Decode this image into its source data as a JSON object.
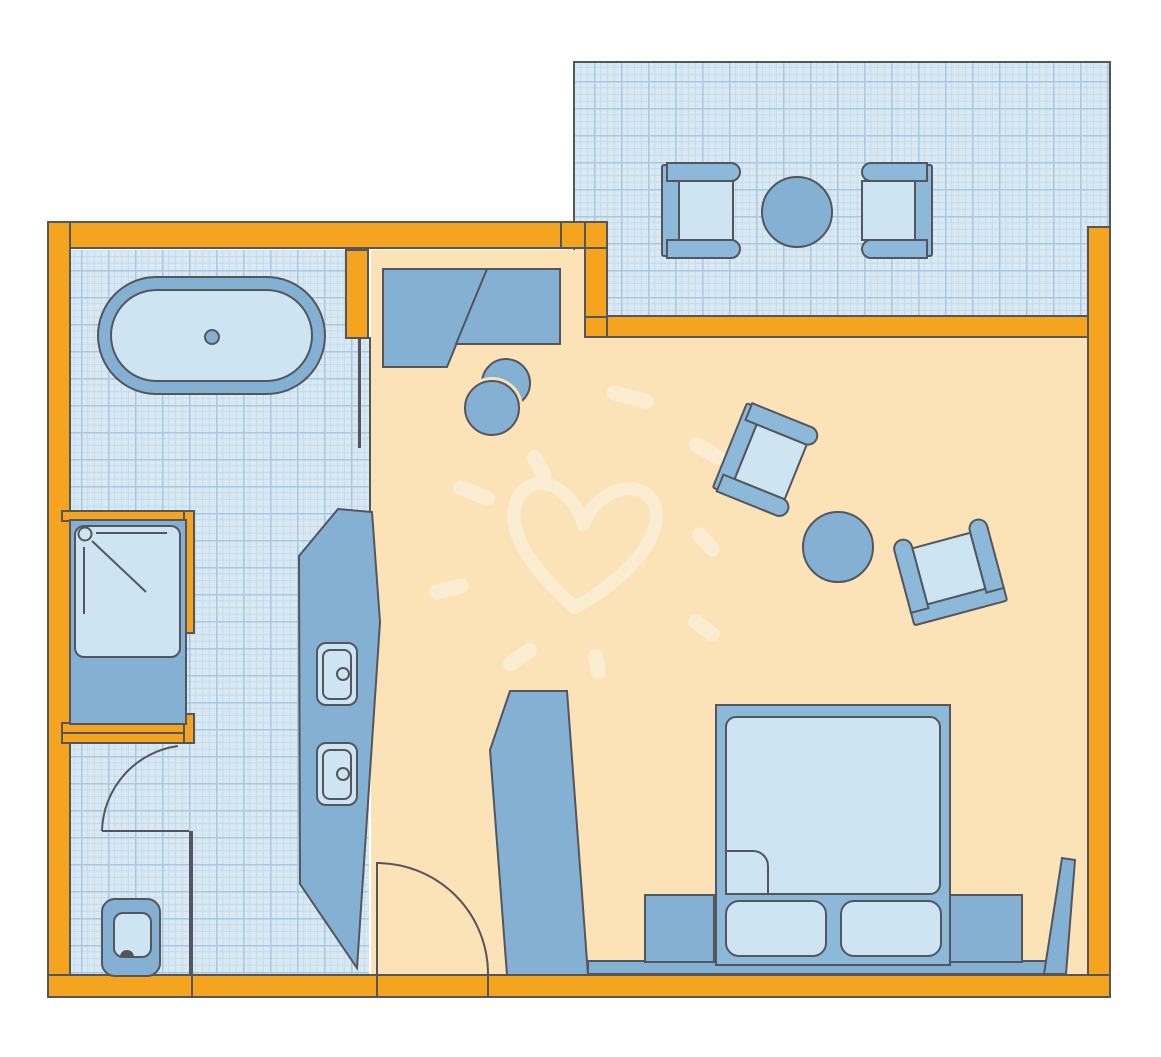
{
  "meta": {
    "kind": "floor-plan",
    "description": "Hotel room floor plan: bathroom with bathtub, shower, WC and twin-sink vanity on the left; bedroom with double bed, nightstands, desk, desk chair, two armchairs and side table; tiled balcony at top with two chairs and a round table; a decorative heart with sparkle rays drawn on the bedroom carpet.",
    "text_content": "none — the plan contains no visible text, numbers or labels"
  },
  "colors": {
    "background": "#FFFFFF",
    "wall": "#F4A41E",
    "line": "#54555D",
    "carpet": "#FCE3B7",
    "tile_bg": "#D9E9F4",
    "tile_minor": "#C4DBEB",
    "tile_major": "#A6C8E0",
    "furniture": "#8CB9D9",
    "furniture_deep": "#84B1D3",
    "furniture_light": "#CDE4F3",
    "cream": "#FAEDD2"
  },
  "rooms": [
    {
      "id": "bathroom",
      "name": "bathroom",
      "floor": "blue tile grid"
    },
    {
      "id": "bedroom",
      "name": "bedroom / living area",
      "floor": "peach carpet"
    },
    {
      "id": "balcony",
      "name": "balcony",
      "floor": "blue tile grid"
    }
  ],
  "fixtures": [
    {
      "id": "bathtub",
      "room": "bathroom",
      "label": "oval bathtub with drain"
    },
    {
      "id": "shower",
      "room": "bathroom",
      "label": "shower cabin with head and glass door"
    },
    {
      "id": "toilet",
      "room": "bathroom",
      "label": "WC in separate niche"
    },
    {
      "id": "vanity",
      "room": "bathroom",
      "label": "counter with two wash basins"
    },
    {
      "id": "bathroom-door",
      "room": "bathroom",
      "label": "door with swing arc"
    },
    {
      "id": "entry-door",
      "room": "bedroom",
      "label": "entrance door with swing arc"
    },
    {
      "id": "wardrobe",
      "room": "bedroom",
      "label": "tall wardrobe"
    },
    {
      "id": "desk",
      "room": "bedroom",
      "label": "desk / sideboard unit"
    },
    {
      "id": "desk-chair",
      "room": "bedroom",
      "label": "round desk chair"
    },
    {
      "id": "armchair-a",
      "room": "bedroom",
      "label": "armchair (rotated)"
    },
    {
      "id": "armchair-b",
      "room": "bedroom",
      "label": "armchair (rotated)"
    },
    {
      "id": "side-table",
      "room": "bedroom",
      "label": "round side table"
    },
    {
      "id": "double-bed",
      "room": "bedroom",
      "label": "double bed with two pillows and turned-down sheet"
    },
    {
      "id": "nightstand-left",
      "room": "bedroom",
      "label": "nightstand"
    },
    {
      "id": "nightstand-right",
      "room": "bedroom",
      "label": "nightstand"
    },
    {
      "id": "wall-ledge",
      "room": "bedroom",
      "label": "low ledge along bottom wall"
    },
    {
      "id": "leaning-board",
      "room": "bedroom",
      "label": "board leaning on right wall"
    },
    {
      "id": "balcony-chair-left",
      "room": "balcony",
      "label": "balcony chair"
    },
    {
      "id": "balcony-chair-right",
      "room": "balcony",
      "label": "balcony chair"
    },
    {
      "id": "balcony-table",
      "room": "balcony",
      "label": "round balcony table"
    }
  ],
  "decoration": {
    "heart": "hand-drawn heart outline on carpet",
    "rays": 9
  }
}
